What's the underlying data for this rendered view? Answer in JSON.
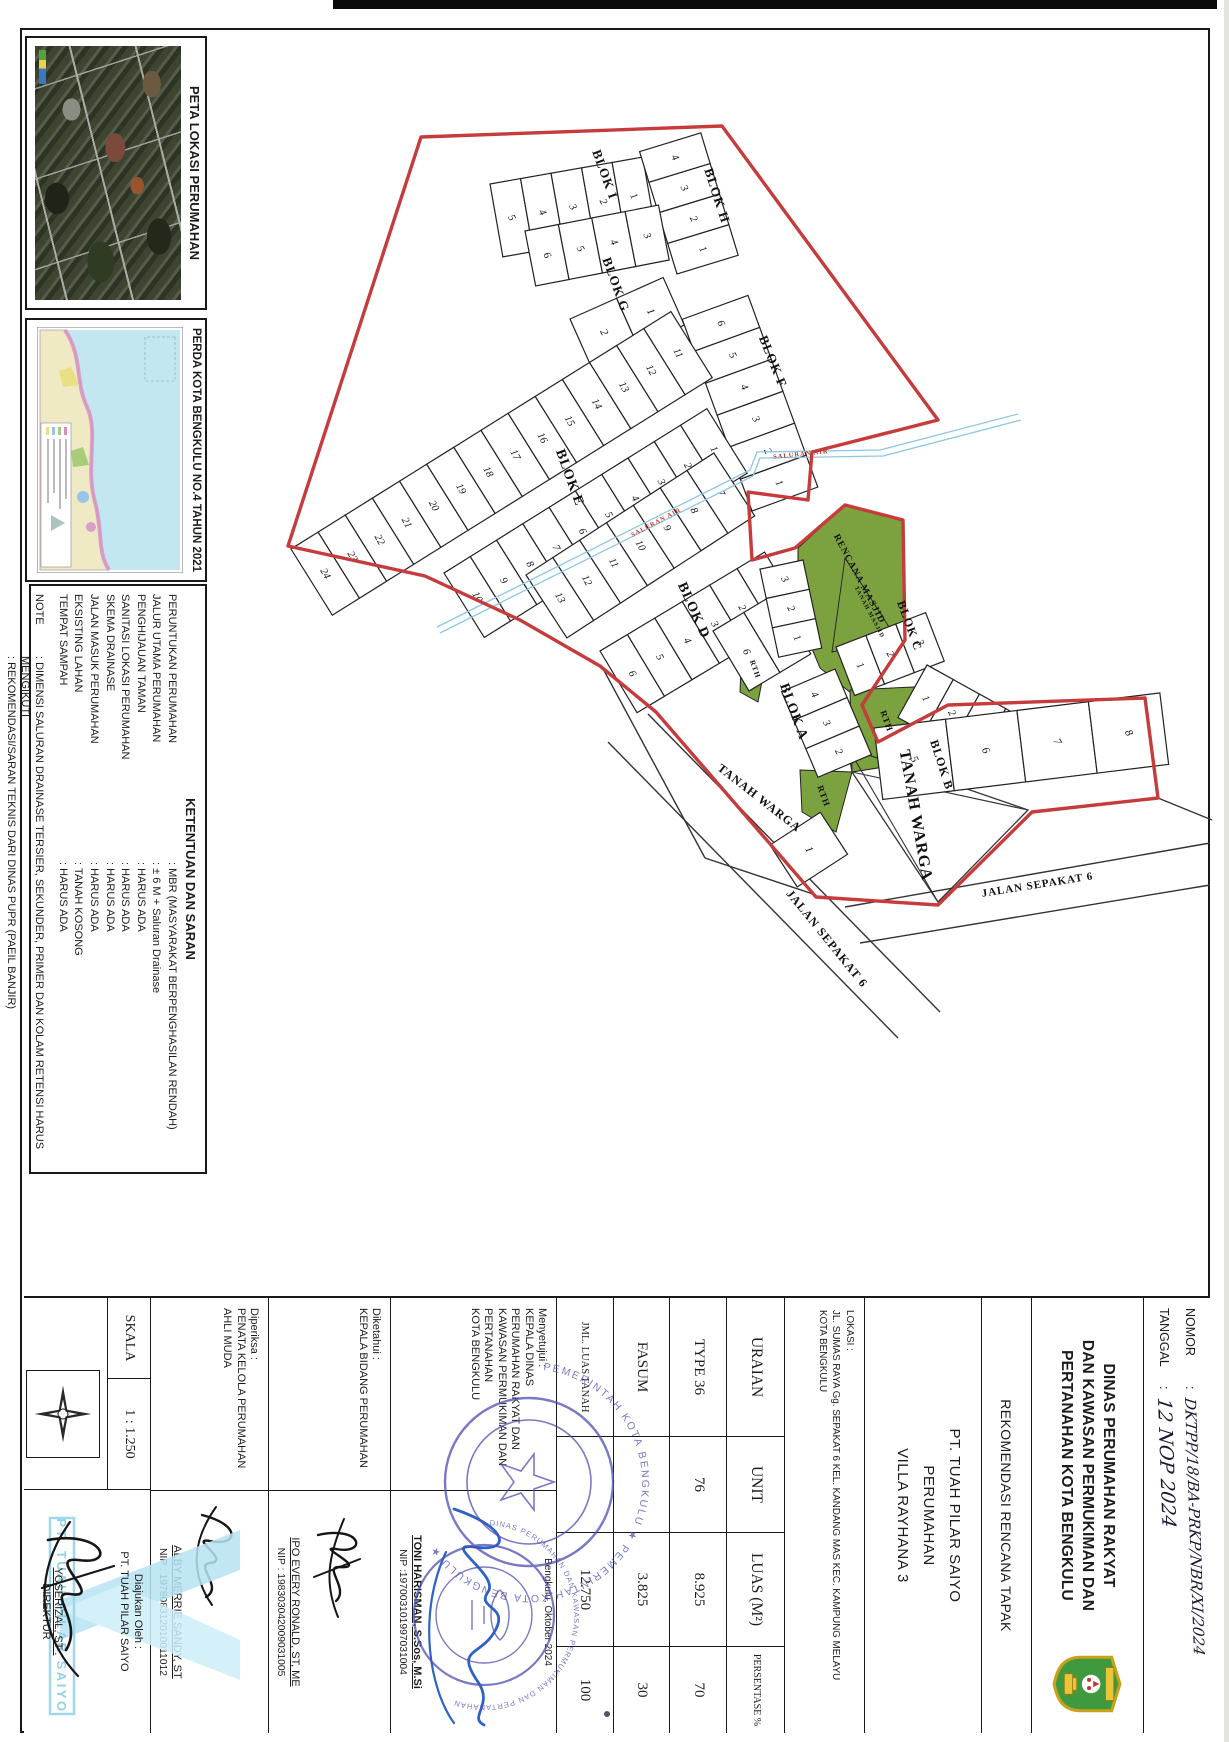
{
  "panels": {
    "peta": {
      "title": "PETA LOKASI PERUMAHAN"
    },
    "perda": {
      "title": "PERDA KOTA BENGKULU NO.4 TAHUN 2021"
    },
    "ketentuan": {
      "title": "KETENTUAN DAN SARAN",
      "rows": [
        {
          "label": "PERUNTUKAN PERUMAHAN",
          "value": ": MBR (MASYARAKAT BERPENGHASILAN RENDAH)"
        },
        {
          "label": "JALUR UTAMA PERUMAHAN",
          "value": ": ± 6 M + Saluran Drainase"
        },
        {
          "label": "PENGHIJAUAN TAMAN",
          "value": ": HARUS ADA"
        },
        {
          "label": "SANITASI LOKASI PERUMAHAN",
          "value": ": HARUS ADA"
        },
        {
          "label": "SKEMA DRAINASE",
          "value": ": HARUS ADA"
        },
        {
          "label": "JALAN MASUK PERUMAHAN",
          "value": ": HARUS ADA"
        },
        {
          "label": "EKSISTING LAHAN",
          "value": ": TANAH KOSONG"
        },
        {
          "label": "TEMPAT SAMPAH",
          "value": ": HARUS ADA"
        }
      ],
      "note_label": "NOTE",
      "note_lines": [
        ": DIMENSI SALURAN DRAINASE TERSIER, SEKUNDER, PRIMER DAN KOLAM RETENSI HARUS MENGIKUTI",
        ": REKOMENDASI/SARAN TEKNIS DARI DINAS PUPR (PAEIL BANJIR)"
      ]
    }
  },
  "titleblock": {
    "nomor_label": "NOMOR",
    "sep": ":",
    "nomor_value": "DKTPP/18/BA-PRKP/NBR/XI/2024",
    "tanggal_label": "TANGGAL",
    "tanggal_value": "12 NOP 2024",
    "agency_lines": [
      "DINAS PERUMAHAN RAKYAT",
      "DAN KAWASAN PERMUKIMAN DAN",
      "PERTANAHAN KOTA BENGKULU"
    ],
    "doc_title": "REKOMENDASI RENCANA TAPAK",
    "developer_lines": [
      "PT. TUAH PILAR SAIYO",
      "PERUMAHAN",
      "VILLA RAYHANA 3"
    ],
    "lokasi_lines": [
      "LOKASI :",
      "JL. SUMAS RAYA Gg. SEPAKAT 6 KEL. KANDANG MAS KEC. KAMPUNG MELAYU",
      "KOTA BENGKULU"
    ],
    "table": {
      "headers": [
        "URAIAN",
        "UNIT",
        "LUAS (M²)",
        "PERSENTASE %"
      ],
      "rows": [
        [
          "TYPE 36",
          "76",
          "8.925",
          "70"
        ],
        [
          "FASUM",
          "",
          "3.825",
          "30"
        ],
        [
          "JML. LUAS TANAH",
          "",
          "12.750",
          "100"
        ]
      ]
    },
    "signatures": {
      "menyetujui": {
        "heading": [
          "Menyetujui :",
          "KEPALA DINAS",
          "PERUMAHAN RAKYAT DAN",
          "KAWASAN PERMUKIMAN DAN",
          "PERTANAHAN",
          "KOTA BENGKULU"
        ],
        "place_date": "Bengkulu,  Oktober 2024",
        "name": "TONI HARISMAN, S.Sos, M.Si",
        "nip": "NIP :197003101997031004"
      },
      "diketahui": {
        "heading": [
          "Diketahui :",
          "KEPALA BIDANG PERUMAHAN"
        ],
        "name": "IPO EVERY RONALD, ST, ME",
        "nip": "NIP : 198303042009031005"
      },
      "diperiksa": {
        "heading": [
          "Diperiksa :",
          "PENATA KELOLA PERUMAHAN",
          "AHLI MUDA"
        ],
        "name": "ALBY MERRIE SANDY, ST",
        "nip": "NIP : 197808312010011012"
      },
      "diajukan": {
        "heading": [
          "Diajukan Oleh :",
          "PT. TUAH PILAR SAIYO"
        ],
        "name": "YOSERIZAL, ST .",
        "title": "DIREKTUR"
      }
    },
    "skala_label": "SKALA",
    "skala_value": "1 : 1.250",
    "stamp1_text": "PEMERINTAH KOTA BENGKULU ★ PEMERINTAH KOTA BENGKULU ★",
    "stamp2_text": "DINAS PERUMAHAN DAN KAWASAN PERMUKIMAN DAN PERTANAHAN",
    "watermark": "PT. TUAH PILAR SAIYO"
  },
  "plan": {
    "boundary": "M288,546 L421,137 L722,126 L938,420 L812,452 L808,500 L748,492 L752,560 L795,548 L845,505 L903,520 L905,640 L862,705 L878,742 L948,705 L1145,698 L1158,798 L1032,812 L938,905 L816,897 L656,712 L600,666 L520,620 L425,576 Z",
    "drain": "M437,627 L750,470 L757,452 L880,450 L1018,414",
    "roads": [
      [
        608,
        742,
        898,
        1038
      ],
      [
        648,
        714,
        940,
        1012
      ],
      [
        845,
        907,
        1210,
        843
      ],
      [
        860,
        943,
        1210,
        885
      ],
      [
        1158,
        798,
        1212,
        820
      ],
      [
        601,
        665,
        705,
        858
      ],
      [
        705,
        858,
        816,
        895
      ]
    ],
    "aux_paths": [
      {
        "d": "M848,748 L1028,810 L938,902 L852,772 Z",
        "stroke": "#333",
        "sw": 1.3
      },
      {
        "d": "M848,748 L938,902",
        "stroke": "#333",
        "sw": 1.1
      },
      {
        "d": "M1028,810 L852,772",
        "stroke": "#333",
        "sw": 1.1
      },
      {
        "d": "M845,558 L896,638 L832,652 Z",
        "stroke": "#222",
        "sw": 0.9
      }
    ],
    "greens": [
      "M798,548 L845,505 L903,520 L905,640 L862,702 L820,668 L798,615 Z",
      "M850,690 L935,686 L916,762 L852,772 Z",
      "M800,770 L852,772 L836,832 L802,812 Z",
      "M742,642 L768,650 L758,702 L740,692 Z"
    ],
    "strips": [
      {
        "x": 490,
        "y": 184,
        "rot": -10,
        "cw": 31,
        "ch": 74,
        "nums": [
          "5",
          "4",
          "3",
          "2",
          "1"
        ]
      },
      {
        "x": 677,
        "y": 274,
        "rot": -107,
        "cw": 32,
        "ch": 64,
        "nums": [
          "1",
          "2",
          "3",
          "4"
        ]
      },
      {
        "x": 525,
        "y": 231,
        "rot": -11,
        "cw": 34,
        "ch": 56,
        "nums": [
          "6",
          "5",
          "4",
          "3"
        ]
      },
      {
        "x": 570,
        "y": 319,
        "rot": -24,
        "cw": 51,
        "ch": 52,
        "nums": [
          "2",
          "1"
        ]
      },
      {
        "x": 752,
        "y": 511,
        "rot": -110,
        "cw": 34,
        "ch": 70,
        "nums": [
          "1",
          "2",
          "3",
          "4",
          "5",
          "6"
        ]
      },
      {
        "x": 291,
        "y": 549,
        "rot": -32,
        "cw": 32,
        "ch": 78,
        "nums": [
          "24",
          "23",
          "22",
          "21",
          "20",
          "19",
          "18",
          "17",
          "16",
          "15",
          "14",
          "13",
          "12",
          "11"
        ]
      },
      {
        "x": 444,
        "y": 573,
        "rot": -32,
        "cw": 31,
        "ch": 76,
        "nums": [
          "10",
          "9",
          "8",
          "7",
          "6",
          "5",
          "4",
          "3",
          "2",
          "1"
        ]
      },
      {
        "x": 526,
        "y": 575,
        "rot": -33,
        "cw": 32,
        "ch": 75,
        "nums": [
          "13",
          "12",
          "11",
          "10",
          "9",
          "8",
          "7"
        ]
      },
      {
        "x": 600,
        "y": 651,
        "rot": -31,
        "cw": 32,
        "ch": 72,
        "nums": [
          "6",
          "5",
          "4",
          "3",
          "2",
          "1"
        ]
      },
      {
        "x": 713,
        "y": 631,
        "rot": -31,
        "cw": 36,
        "ch": 70,
        "nums": [
          "6",
          "5"
        ]
      },
      {
        "x": 835,
        "y": 669,
        "rot": 67,
        "cw": 31,
        "ch": 58,
        "nums": [
          "4",
          "3",
          "2"
        ]
      },
      {
        "x": 770,
        "y": 845,
        "rot": -33,
        "cw": 60,
        "ch": 50,
        "nums": [
          "1"
        ]
      },
      {
        "x": 836,
        "y": 647,
        "rot": -21,
        "cw": 32,
        "ch": 52,
        "nums": [
          "1",
          "2",
          "3"
        ]
      },
      {
        "x": 803,
        "y": 560,
        "rot": 78,
        "cw": 30,
        "ch": 44,
        "nums": [
          "3",
          "2",
          "1"
        ]
      },
      {
        "x": 927,
        "y": 665,
        "rot": 29,
        "cw": 30,
        "ch": 60,
        "nums": [
          "1",
          "2",
          "3",
          "4"
        ]
      },
      {
        "x": 874,
        "y": 728,
        "rot": -7,
        "cw": 72,
        "ch": 72,
        "nums": [
          "5",
          "6",
          "7",
          "8"
        ]
      }
    ],
    "labels": [
      {
        "t": "BLOK I",
        "x": 601,
        "y": 176,
        "r": 70,
        "s": 13
      },
      {
        "t": "BLOK H",
        "x": 713,
        "y": 197,
        "r": 72,
        "s": 13
      },
      {
        "t": "BLOK G",
        "x": 612,
        "y": 286,
        "r": 70,
        "s": 13
      },
      {
        "t": "BLOK F",
        "x": 769,
        "y": 363,
        "r": 68,
        "s": 13
      },
      {
        "t": "BLOK E",
        "x": 566,
        "y": 479,
        "r": 70,
        "s": 14
      },
      {
        "t": "BLOK D",
        "x": 690,
        "y": 612,
        "r": 66,
        "s": 14
      },
      {
        "t": "BLOK A",
        "x": 790,
        "y": 713,
        "r": 70,
        "s": 14
      },
      {
        "t": "BLOK C",
        "x": 906,
        "y": 627,
        "r": 70,
        "s": 12
      },
      {
        "t": "BLOK B",
        "x": 938,
        "y": 766,
        "r": 72,
        "s": 12
      },
      {
        "t": "TANAH WARGA",
        "x": 757,
        "y": 801,
        "r": 38,
        "s": 12
      },
      {
        "t": "TANAH WARGA",
        "x": 911,
        "y": 816,
        "r": 80,
        "s": 16
      },
      {
        "t": "JALAN SEPAKAT 6",
        "x": 824,
        "y": 941,
        "r": 51,
        "s": 12
      },
      {
        "t": "JALAN SEPAKAT 6",
        "x": 1038,
        "y": 888,
        "r": -9,
        "s": 11
      },
      {
        "t": "RENCANA MASJID",
        "x": 857,
        "y": 580,
        "r": 62,
        "s": 9.5
      },
      {
        "t": "TANAH MASJID",
        "x": 868,
        "y": 613,
        "r": 62,
        "s": 6
      },
      {
        "t": "RTH",
        "x": 884,
        "y": 722,
        "r": 70,
        "s": 9
      },
      {
        "t": "RTH",
        "x": 821,
        "y": 797,
        "r": 70,
        "s": 9
      },
      {
        "t": "RTH",
        "x": 753,
        "y": 670,
        "r": 70,
        "s": 7.5
      },
      {
        "t": "SALURAN AIR",
        "x": 657,
        "y": 524,
        "r": -28,
        "s": 6.5,
        "c": "#c0392b"
      },
      {
        "t": "SALURAN AIR",
        "x": 801,
        "y": 456,
        "r": -6,
        "s": 6.5,
        "c": "#c0392b"
      }
    ]
  },
  "colors": {
    "boundary": "#c63b3b",
    "green": "#7ba23f",
    "drain": "#8ec6e6",
    "line": "#222222",
    "stamp": "#4d4db4",
    "watermark": "#aadcf0"
  }
}
